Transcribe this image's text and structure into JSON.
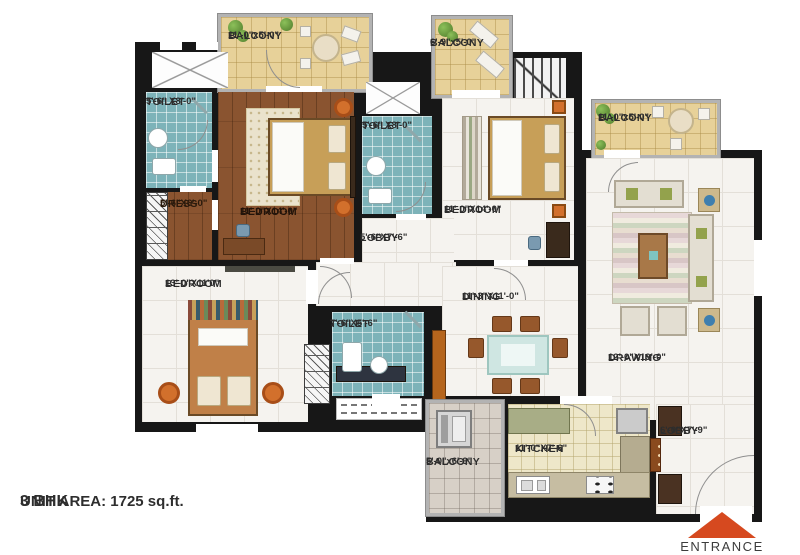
{
  "footer": {
    "title": "3 BHK",
    "area": "UNIT AREA: 1725 sq.ft."
  },
  "entrance": {
    "label": "ENTRANCE"
  },
  "rooms": {
    "balcony_top_left": {
      "name": "BALCONY",
      "dims": "11'-0\"x5'-0\""
    },
    "balcony_top_mid": {
      "name": "BALCONY",
      "dims": "6'-9\"x5'-0\""
    },
    "balcony_right": {
      "name": "BALCONY",
      "dims": "11'-0\"x5'-0\""
    },
    "balcony_bottom": {
      "name": "BALCONY",
      "dims": "5'-0\"x6'-9\""
    },
    "toilet_top_left": {
      "name": "TOILET",
      "dims": "5'-6\" X8'-0\""
    },
    "toilet_mid": {
      "name": "TOILET",
      "dims": "5'-6\" X8'-0\""
    },
    "toilet_bottom": {
      "name": "TOILET",
      "dims": "7'-6\"X5'-6\""
    },
    "dress": {
      "name": "DRESS",
      "dims": "5'-6\"X6'-0\""
    },
    "bedroom_master": {
      "name": "BEDROOM",
      "dims": "11'-0\"X14'-0\""
    },
    "bedroom_top_right": {
      "name": "BEDROOM",
      "dims": "11'-0\"X14'-0\""
    },
    "bedroom_bottom_left": {
      "name": "BEDROOM",
      "dims": "13'-0\"X11'0\""
    },
    "lobby_mid": {
      "name": "LOBBY",
      "dims": "5'-6\"X7'-6\""
    },
    "lobby_entry": {
      "name": "LOBBY",
      "dims": "6'-0\"X7'-9\""
    },
    "dining": {
      "name": "DINING",
      "dims": "11'-3\"X11'-0\""
    },
    "drawing": {
      "name": "DRAWING",
      "dims": "12'-0\"X19'-0\""
    },
    "kitchen": {
      "name": "KITCHEN",
      "dims": "11'-0\"X7'-6\""
    }
  },
  "colors": {
    "wall": "#171717",
    "toilet_tile": "#7db3b9",
    "wood_floor": "#8a5430",
    "balcony_floor": "#e7d199",
    "marble_floor": "#f5f3ef",
    "kitchen_floor": "#eee7c9",
    "entrance_arrow": "#d6491f"
  }
}
